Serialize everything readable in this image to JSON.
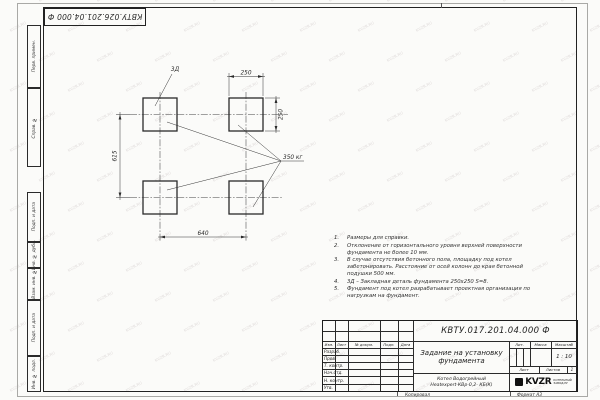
{
  "watermark": {
    "text": "KVZR.RU"
  },
  "sheet": {
    "top_stamp": "КВТУ.026.201.04.000 Ф",
    "margin_columns": [
      {
        "label": "Перв. примен."
      },
      {
        "label": "Справ. №"
      },
      {
        "label": "Подп. и дата"
      },
      {
        "label": "Инв. № дубл."
      },
      {
        "label": "Взам. инв. №"
      },
      {
        "label": "Подп. и дата"
      },
      {
        "label": "Инв. № подл."
      }
    ],
    "footer": {
      "copy_label": "Копировал",
      "format_label": "Формат А3"
    }
  },
  "drawing": {
    "callout_label": "3Д",
    "load_label": "350 кг",
    "dim_top": "250",
    "dim_right": "250",
    "dim_left": "615",
    "dim_bottom": "640"
  },
  "notes": [
    {
      "num": "1.",
      "text": "Размеры для справки."
    },
    {
      "num": "2.",
      "text": "Отклонение от горизонтального уровня верхней поверхности фундамента не более 10 мм."
    },
    {
      "num": "3.",
      "text": "В случае отсутствия бетонного пола, площадку под котел забетонировать. Расстояние от осей колонн до края бетонной подушки 500 мм."
    },
    {
      "num": "4.",
      "text": "3Д – Закладная деталь фундамента 250х250 S=8."
    },
    {
      "num": "5.",
      "text": "Фундамент под котел разрабатывает проектная организация по нагрузкам на фундамент."
    }
  ],
  "title_block": {
    "designation": "КВТУ.017.201.04.000 Ф",
    "doc_title": "Задание на установку фундамента",
    "product_line1": "Котел Водогрейный",
    "product_line2": "Heatexpert-КВр-0,2- КБ(К)",
    "header_cols": [
      "Изм.",
      "Лист",
      "№ докум.",
      "Подп.",
      "Дата"
    ],
    "row_labels": [
      "Разраб.",
      "Пров.",
      "Т. контр.",
      "Нач.отд.",
      "Н. контр.",
      "Утв."
    ],
    "lit_label": "Лит.",
    "mass_label": "Масса",
    "scale_label": "Масштаб",
    "scale_value": "1 : 10",
    "sheet_label": "Лист",
    "sheets_label": "Листов",
    "sheets_value": "1",
    "company": {
      "logo_text": "KVZR",
      "tagline_line1": "КОТЕЛЬНЫЙ",
      "tagline_line2": "ЗАВОД.РУ"
    }
  }
}
